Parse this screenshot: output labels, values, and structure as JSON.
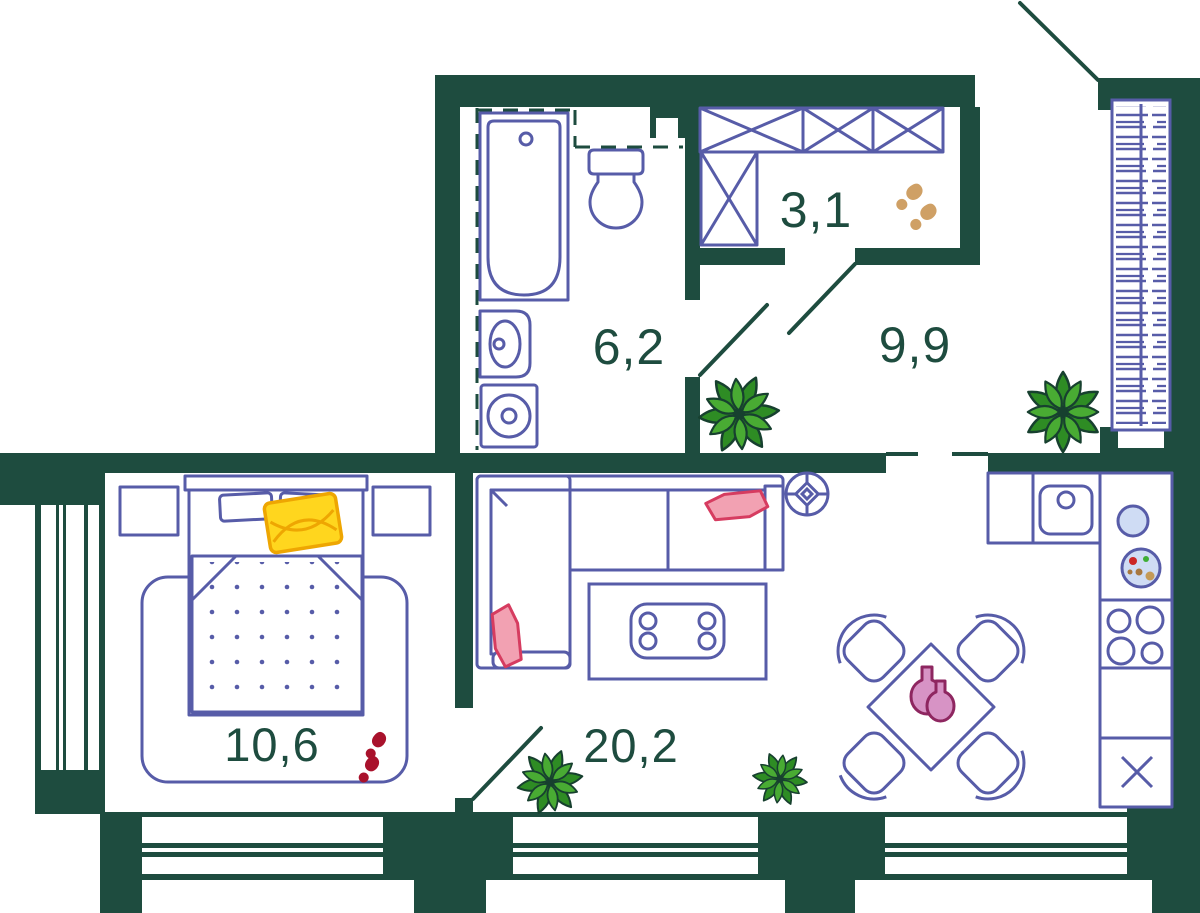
{
  "title": "Apartment floor plan",
  "plan": {
    "rooms": [
      {
        "id": "wardrobe",
        "area": "3,1"
      },
      {
        "id": "bathroom",
        "area": "6,2"
      },
      {
        "id": "hallway",
        "area": "9,9"
      },
      {
        "id": "bedroom",
        "area": "10,6"
      },
      {
        "id": "living-kitchen",
        "area": "20,2"
      }
    ],
    "colors": {
      "wall": "#1e4c3f",
      "furniture_outline": "#575ca8",
      "label_text": "#1e4c3f",
      "plant_green": "#49ab33",
      "plant_green_dark": "#2e8c24",
      "pillow_pink": "#f2a1b2",
      "pillow_pink_stroke": "#d63c60",
      "pillow_yellow": "#ffd61e",
      "pillow_yellow_stroke": "#eea602",
      "vase_fill": "#d793c5",
      "vase_stroke": "#8e2660",
      "footprints_red": "#a9122c",
      "footprints_tan": "#cfa065",
      "appliance_blue": "#cfdcf4"
    },
    "icons": [
      "bathtub",
      "toilet",
      "washbasin",
      "washing-machine",
      "wardrobe-units",
      "hanger-rail",
      "kitchen-sink",
      "stove",
      "fridge",
      "dining-table",
      "chairs",
      "vases",
      "sofa",
      "pillows",
      "coffee-table",
      "rug",
      "double-bed",
      "nightstands",
      "plants",
      "footprints",
      "ceiling-light",
      "door-swings",
      "windows"
    ]
  }
}
